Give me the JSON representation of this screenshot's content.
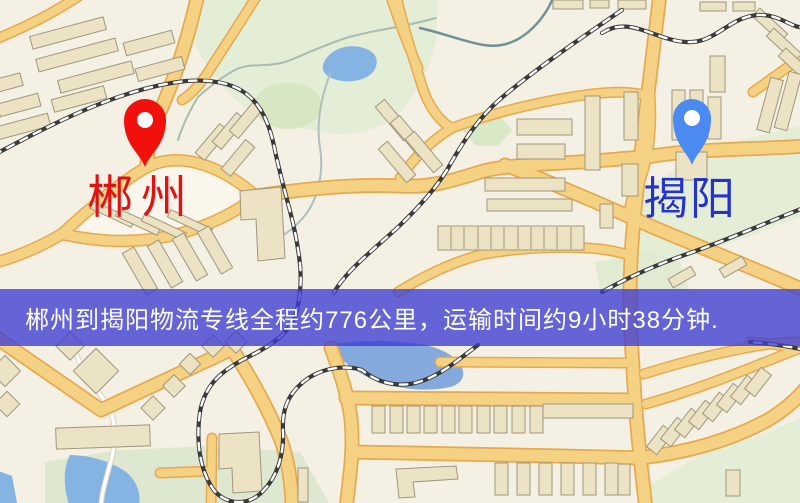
{
  "origin": {
    "label": "郴州",
    "label_color": "#e01212",
    "pin_color": "#f2100d"
  },
  "destination": {
    "label": "揭阳",
    "label_color": "#2433cc",
    "pin_color": "#4b8af0"
  },
  "banner": {
    "text": "郴州到揭阳物流专线全程约776公里，运输时间约9小时38分钟.",
    "background_color": "#3C3CD4C7",
    "text_color": "#ffffff",
    "distance_km": "776",
    "duration": "9小时38分钟"
  },
  "map_colors": {
    "background": "#f5f0e4",
    "park": "#e4eed6",
    "field": "#dee7d0",
    "water": "#85b4e2",
    "road_fill": "#f5d283",
    "road_casing": "#e6a94f",
    "building_fill": "#ece2c4",
    "building_stroke": "#a0967c",
    "railway": "#3a3a3a",
    "white_road": "#ffffff"
  }
}
